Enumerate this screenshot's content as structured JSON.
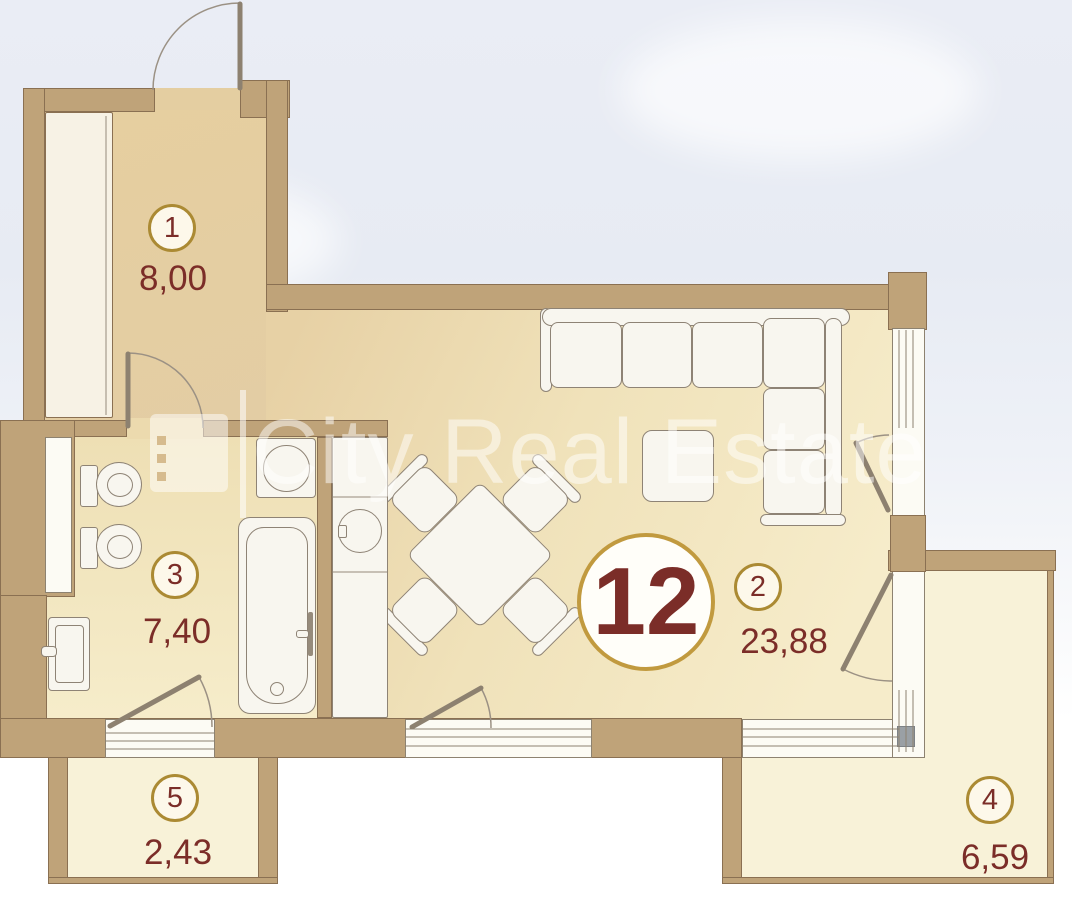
{
  "apartment": {
    "number": "12"
  },
  "watermark": {
    "text": "City Real Estate",
    "logo": "city-real-estate-logo"
  },
  "rooms": [
    {
      "number": "1",
      "area": "8,00"
    },
    {
      "number": "2",
      "area": "23,88"
    },
    {
      "number": "3",
      "area": "7,40"
    },
    {
      "number": "4",
      "area": "6,59"
    },
    {
      "number": "5",
      "area": "2,43"
    }
  ],
  "colors": {
    "wall_tan": "#bfa379",
    "wall_outline": "#8a7052",
    "accent_gold": "#ab8a33",
    "badge_gold": "#c19a3f",
    "label_maroon": "#7b2d28",
    "floor_hall": "#e5cfa2",
    "floor_living_light": "#f6ecca",
    "floor_balcony": "#f8f2d8",
    "window_white": "#fcfbf4"
  }
}
